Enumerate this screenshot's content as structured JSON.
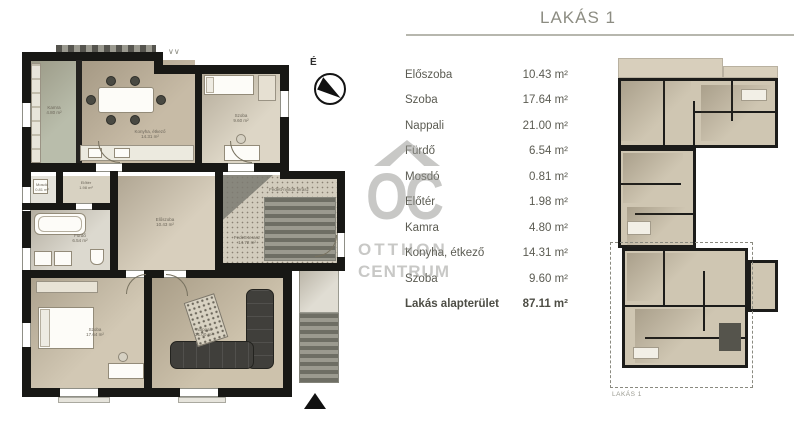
{
  "title": "LAKÁS 1",
  "table": {
    "rows": [
      {
        "label": "Előszoba",
        "area": "10.43 m²"
      },
      {
        "label": "Szoba",
        "area": "17.64 m²"
      },
      {
        "label": "Nappali",
        "area": "21.00 m²"
      },
      {
        "label": "Fürdő",
        "area": "6.54 m²"
      },
      {
        "label": "Mosdó",
        "area": "0.81 m²"
      },
      {
        "label": "Előtér",
        "area": "1.98 m²"
      },
      {
        "label": "Kamra",
        "area": "4.80 m²"
      },
      {
        "label": "Konyha, étkező",
        "area": "14.31 m²"
      },
      {
        "label": "Szoba",
        "area": "9.60 m²"
      }
    ],
    "total": {
      "label": "Lakás alapterület",
      "area": "87.11 m²"
    }
  },
  "watermark": {
    "logo": "OC",
    "line1": "OTTHON",
    "line2": "CENTRUM"
  },
  "compass_label": "É",
  "plan": {
    "kamra": {
      "name": "Kamra",
      "area": "4.80 m²"
    },
    "konyha": {
      "name": "Konyha, étkező",
      "area": "14.31 m²"
    },
    "szoba_kis": {
      "name": "Szoba",
      "area": "9.60 m²"
    },
    "eloszoba": {
      "name": "Előszoba",
      "area": "10.43 m²"
    },
    "furdo": {
      "name": "Fürdő",
      "area": "6.54 m²"
    },
    "mosdo": {
      "name": "Mosdó",
      "area": "0.81 m²"
    },
    "eloter": {
      "name": "Előtér",
      "area": "1.98 m²"
    },
    "szoba_nagy": {
      "name": "Szoba",
      "area": "17.64 m²"
    },
    "nappali": {
      "name": "Nappali",
      "area": "21.00 m²"
    },
    "terasz_felso": {
      "name": "Fedett-nyitott terasz"
    },
    "terasz_also": {
      "name": "Fedett terasz",
      "area": "14.72 m²"
    }
  },
  "overview": {
    "caption": "LAKÁS 1"
  },
  "colors": {
    "wall": "#181815",
    "floor_light": "#d8cfbd",
    "floor_kitchen": "#c7bba6",
    "pantry": "#b9bdab",
    "shadow": "#a79a82",
    "terrace_gray": "#9b9a8f",
    "sofa": "#403f3b",
    "title_text": "#8c8c82",
    "table_text": "#5b5b52",
    "watermark": "#93938f"
  }
}
